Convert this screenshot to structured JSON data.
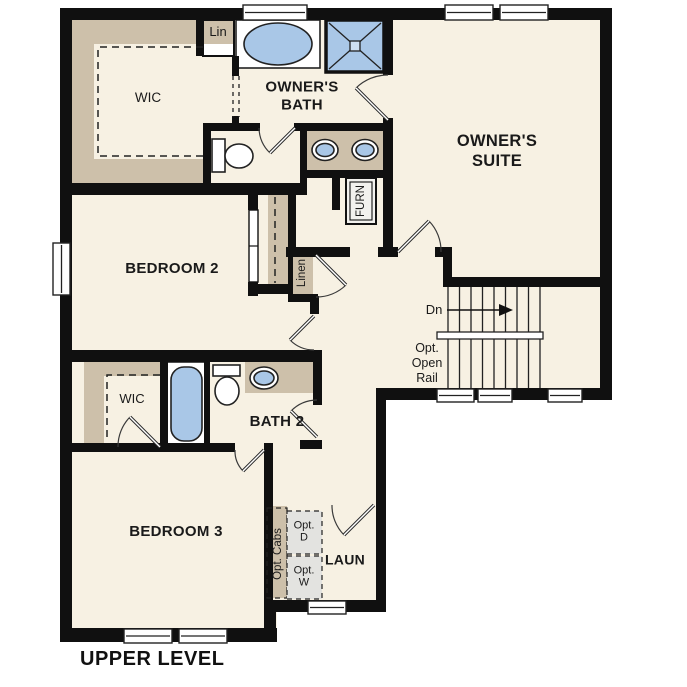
{
  "colors": {
    "wall": "#101010",
    "floor": "#f7f1e3",
    "closet": "#cdc0aa",
    "fixture": "#a9c7e7",
    "appliance": "#e3e3e0",
    "line": "#222222",
    "text": "#1a1a1a"
  },
  "labels": {
    "title": "UPPER LEVEL",
    "lin": "Lin",
    "owners_wic": "WIC",
    "owners_bath": "OWNER'S\nBATH",
    "owners_suite": "OWNER'S\nSUITE",
    "furn": "FURN",
    "bedroom2": "BEDROOM 2",
    "linen": "Linen",
    "dn": "Dn",
    "opt_open_rail": "Opt.\nOpen\nRail",
    "wic2": "WIC",
    "bath2": "BATH 2",
    "bedroom3": "BEDROOM 3",
    "opt_cabs": "Opt. Cabs",
    "opt_d": "Opt.\nD",
    "opt_w": "Opt.\nW",
    "laun": "LAUN"
  }
}
